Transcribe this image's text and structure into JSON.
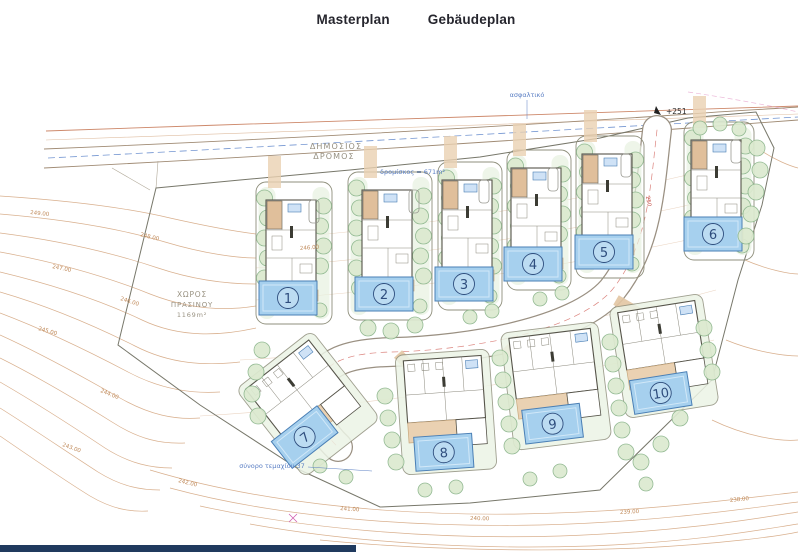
{
  "header": {
    "tabs": [
      {
        "label": "Masterplan",
        "active": true
      },
      {
        "label": "Gebäudeplan",
        "active": false
      }
    ]
  },
  "plan": {
    "labels": {
      "public_road_line1": "ΔΗΜΟΣΙΟΣ",
      "public_road_line2": "ΔΡΟΜΟΣ",
      "road_area_note": "δρομίσκος = 671m²",
      "green_space_line1": "ΧΩΡΟΣ",
      "green_space_line2": "ΠΡΑΣΙΝΟΥ",
      "green_space_area": "1169m²",
      "spot_height": "+251",
      "boundary_note": "σύνορο τεμαχίου 37",
      "surface_note": "ασφαλτικό",
      "road_level": "250"
    },
    "contour_labels": [
      {
        "text": "249.00",
        "x": 30,
        "y": 214,
        "rot": 6
      },
      {
        "text": "248.00",
        "x": 140,
        "y": 236,
        "rot": 14
      },
      {
        "text": "247.00",
        "x": 52,
        "y": 268,
        "rot": 12
      },
      {
        "text": "246.00",
        "x": 120,
        "y": 300,
        "rot": 18
      },
      {
        "text": "245.00",
        "x": 38,
        "y": 330,
        "rot": 16
      },
      {
        "text": "246.00",
        "x": 300,
        "y": 250,
        "rot": -4
      },
      {
        "text": "244.00",
        "x": 100,
        "y": 392,
        "rot": 22
      },
      {
        "text": "243.00",
        "x": 62,
        "y": 446,
        "rot": 20
      },
      {
        "text": "242.00",
        "x": 178,
        "y": 482,
        "rot": 14
      },
      {
        "text": "241.00",
        "x": 340,
        "y": 510,
        "rot": 4
      },
      {
        "text": "240.00",
        "x": 470,
        "y": 520,
        "rot": 1
      },
      {
        "text": "239.00",
        "x": 620,
        "y": 514,
        "rot": -3
      },
      {
        "text": "238.00",
        "x": 730,
        "y": 502,
        "rot": -6
      }
    ],
    "plots": {
      "top": [
        {
          "number": "1",
          "x": 256,
          "y": 182,
          "w": 76,
          "h": 142
        },
        {
          "number": "2",
          "x": 348,
          "y": 172,
          "w": 84,
          "h": 148
        },
        {
          "number": "3",
          "x": 438,
          "y": 162,
          "w": 64,
          "h": 148
        },
        {
          "number": "4",
          "x": 507,
          "y": 150,
          "w": 64,
          "h": 140
        },
        {
          "number": "5",
          "x": 576,
          "y": 136,
          "w": 68,
          "h": 142
        },
        {
          "number": "6",
          "x": 684,
          "y": 122,
          "w": 70,
          "h": 138
        }
      ],
      "bottom": [
        {
          "number": "7",
          "cx": 308,
          "cy": 404,
          "w": 96,
          "h": 112,
          "rot": -38,
          "px": -23,
          "py": 24
        },
        {
          "number": "8",
          "cx": 446,
          "cy": 412,
          "w": 94,
          "h": 120,
          "rot": -4,
          "px": -5,
          "py": 40
        },
        {
          "number": "9",
          "cx": 556,
          "cy": 386,
          "w": 98,
          "h": 118,
          "rot": -7,
          "px": -8,
          "py": 37
        },
        {
          "number": "10",
          "cx": 664,
          "cy": 356,
          "w": 94,
          "h": 112,
          "rot": -9,
          "px": -9,
          "py": 36
        }
      ]
    },
    "trees": [
      [
        757,
        148,
        8
      ],
      [
        760,
        170,
        8
      ],
      [
        756,
        192,
        8
      ],
      [
        751,
        214,
        8
      ],
      [
        746,
        236,
        8
      ],
      [
        700,
        128,
        7
      ],
      [
        720,
        124,
        7
      ],
      [
        739,
        129,
        7
      ],
      [
        368,
        328,
        8
      ],
      [
        391,
        331,
        8
      ],
      [
        415,
        325,
        8
      ],
      [
        470,
        317,
        7
      ],
      [
        492,
        311,
        7
      ],
      [
        540,
        299,
        7
      ],
      [
        562,
        293,
        7
      ],
      [
        385,
        396,
        8
      ],
      [
        388,
        418,
        8
      ],
      [
        392,
        440,
        8
      ],
      [
        396,
        462,
        8
      ],
      [
        500,
        358,
        8
      ],
      [
        503,
        380,
        8
      ],
      [
        506,
        402,
        8
      ],
      [
        509,
        424,
        8
      ],
      [
        512,
        446,
        8
      ],
      [
        610,
        342,
        8
      ],
      [
        613,
        364,
        8
      ],
      [
        616,
        386,
        8
      ],
      [
        619,
        408,
        8
      ],
      [
        622,
        430,
        8
      ],
      [
        626,
        452,
        8
      ],
      [
        704,
        328,
        8
      ],
      [
        708,
        350,
        8
      ],
      [
        712,
        372,
        8
      ],
      [
        641,
        462,
        8
      ],
      [
        661,
        444,
        8
      ],
      [
        680,
        418,
        8
      ],
      [
        646,
        484,
        7
      ],
      [
        262,
        350,
        8
      ],
      [
        256,
        372,
        8
      ],
      [
        252,
        394,
        8
      ],
      [
        258,
        416,
        8
      ],
      [
        320,
        466,
        7
      ],
      [
        346,
        477,
        7
      ],
      [
        425,
        490,
        7
      ],
      [
        456,
        487,
        7
      ],
      [
        530,
        479,
        7
      ],
      [
        560,
        471,
        7
      ]
    ],
    "colors": {
      "contour": "#d2a27a",
      "contour_label": "#c08a5a",
      "top_line": "#c06a45",
      "road_edge": "#a08b74",
      "centerline_blue": "#5b83c9",
      "centerline_red": "#cf5a52",
      "boundary": "#77776a",
      "plot_stroke": "#8f8f7c",
      "green_strip": "#e7f1df",
      "ground_green": "#ecf4e6",
      "tree_fill": "#dcead0",
      "tree_stroke": "#8bb58b",
      "pool_fill": "#a6d0ee",
      "pool_stroke": "#4a7fb5",
      "pool_number": "#2e4d7d",
      "terrace": "#ead1b2",
      "terrace_stroke": "#c8a87e",
      "garage": "#e0bf9b",
      "label_box": "#cfe2f6",
      "building_stroke": "#56544a",
      "tab_color": "#26262e",
      "footer_bar": "#203a5e"
    }
  }
}
